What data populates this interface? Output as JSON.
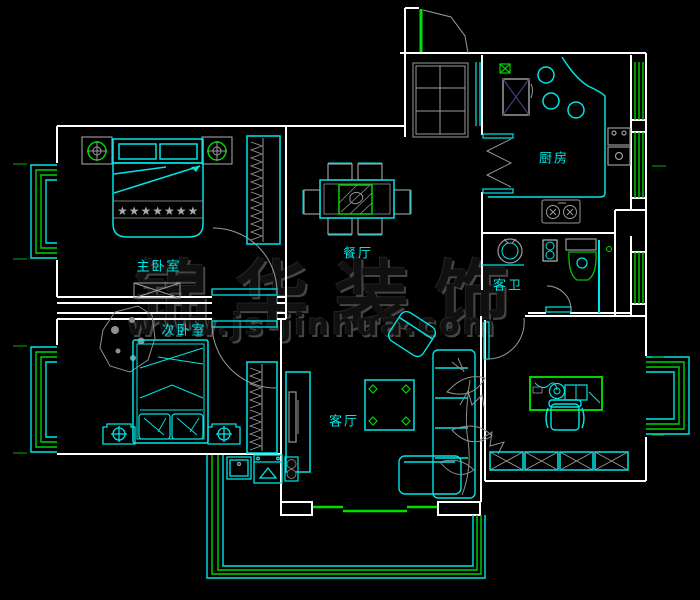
{
  "meta": {
    "drawing_type": "apartment floor plan",
    "style": "CAD blueprint on black",
    "background": "#000000"
  },
  "palette": {
    "walls": "#ffffff",
    "furniture": "#00e5e5",
    "accents": "#00d400",
    "details": "#9a9a9a",
    "hatch_cross": "#3d3d7a",
    "labels": "#00e6e6",
    "watermark": "#2a2a2a"
  },
  "rooms": {
    "master_bedroom": {
      "label": "主卧室"
    },
    "second_bedroom": {
      "label": "次卧室"
    },
    "dining_room": {
      "label": "餐厅"
    },
    "living_room": {
      "label": "客厅"
    },
    "kitchen": {
      "label": "厨房"
    },
    "guest_bathroom": {
      "label": "客卫"
    }
  },
  "watermark": {
    "brand": "锦华装饰",
    "website": "www.js-jinhua.com"
  },
  "fixtures": [
    "entry-door",
    "shoe-cabinet",
    "flue",
    "refrigerator",
    "kitchen-counter",
    "counter-circles",
    "gas-stove",
    "water-heater",
    "folding-door",
    "washbasin",
    "vanity-cabinet",
    "toilet",
    "shower-screen",
    "master-bed",
    "nightstand-lamp",
    "master-wardrobe",
    "bedside-bench",
    "dining-table",
    "dining-chairs",
    "second-bed",
    "plant",
    "second-wardrobe",
    "tv-cabinet",
    "coffee-table",
    "armchair",
    "sofa",
    "flower-decor",
    "computer-desk",
    "desk-chair",
    "storage-cabinets",
    "bay-window",
    "balcony",
    "laundry-sink",
    "washing-machine",
    "door-swing",
    "window-stripes"
  ]
}
